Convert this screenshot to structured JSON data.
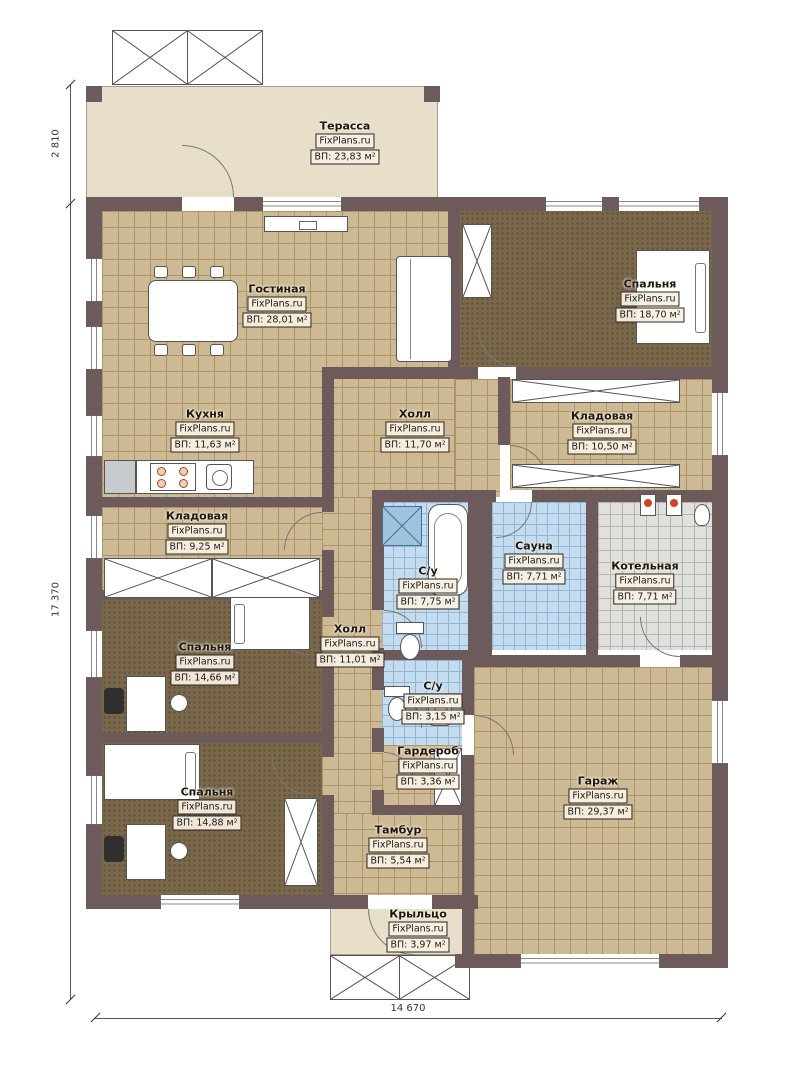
{
  "plan": {
    "watermark": "FixPlans.ru",
    "rooms": {
      "terrace": {
        "name": "Терасса",
        "area": "ВП: 23,83 м²"
      },
      "living": {
        "name": "Гостиная",
        "area": "ВП: 28,01 м²"
      },
      "bedroom1": {
        "name": "Спальня",
        "area": "ВП: 18,70 м²"
      },
      "kitchen": {
        "name": "Кухня",
        "area": "ВП: 11,63 м²"
      },
      "hall1": {
        "name": "Холл",
        "area": "ВП: 11,70 м²"
      },
      "storage1": {
        "name": "Кладовая",
        "area": "ВП: 10,50 м²"
      },
      "storage2": {
        "name": "Кладовая",
        "area": "ВП: 9,25 м²"
      },
      "bath1": {
        "name": "С/у",
        "area": "ВП: 7,75 м²"
      },
      "sauna": {
        "name": "Сауна",
        "area": "ВП: 7,71 м²"
      },
      "boiler": {
        "name": "Котельная",
        "area": "ВП: 7,71 м²"
      },
      "hall2": {
        "name": "Холл",
        "area": "ВП: 11,01 м²"
      },
      "bedroom2": {
        "name": "Спальня",
        "area": "ВП: 14,66 м²"
      },
      "bath2": {
        "name": "С/у",
        "area": "ВП: 3,15 м²"
      },
      "wardrobe": {
        "name": "Гардероб",
        "area": "ВП: 3,36 м²"
      },
      "bedroom3": {
        "name": "Спальня",
        "area": "ВП: 14,88 м²"
      },
      "garage": {
        "name": "Гараж",
        "area": "ВП: 29,37 м²"
      },
      "tambour": {
        "name": "Тамбур",
        "area": "ВП: 5,54 м²"
      },
      "porch": {
        "name": "Крыльцо",
        "area": "ВП: 3,97 м²"
      }
    },
    "dimensions": {
      "terrace_height": "2 810",
      "total_height": "17 370",
      "total_width": "14 670"
    },
    "colors": {
      "wall": "#6d5a5a",
      "tile_beige": "#cdb993",
      "carpet_brown": "#7b684a",
      "tile_blue": "#c4dcee",
      "tile_gray": "#e0e0dc",
      "terrace": "#e7dfca"
    }
  }
}
